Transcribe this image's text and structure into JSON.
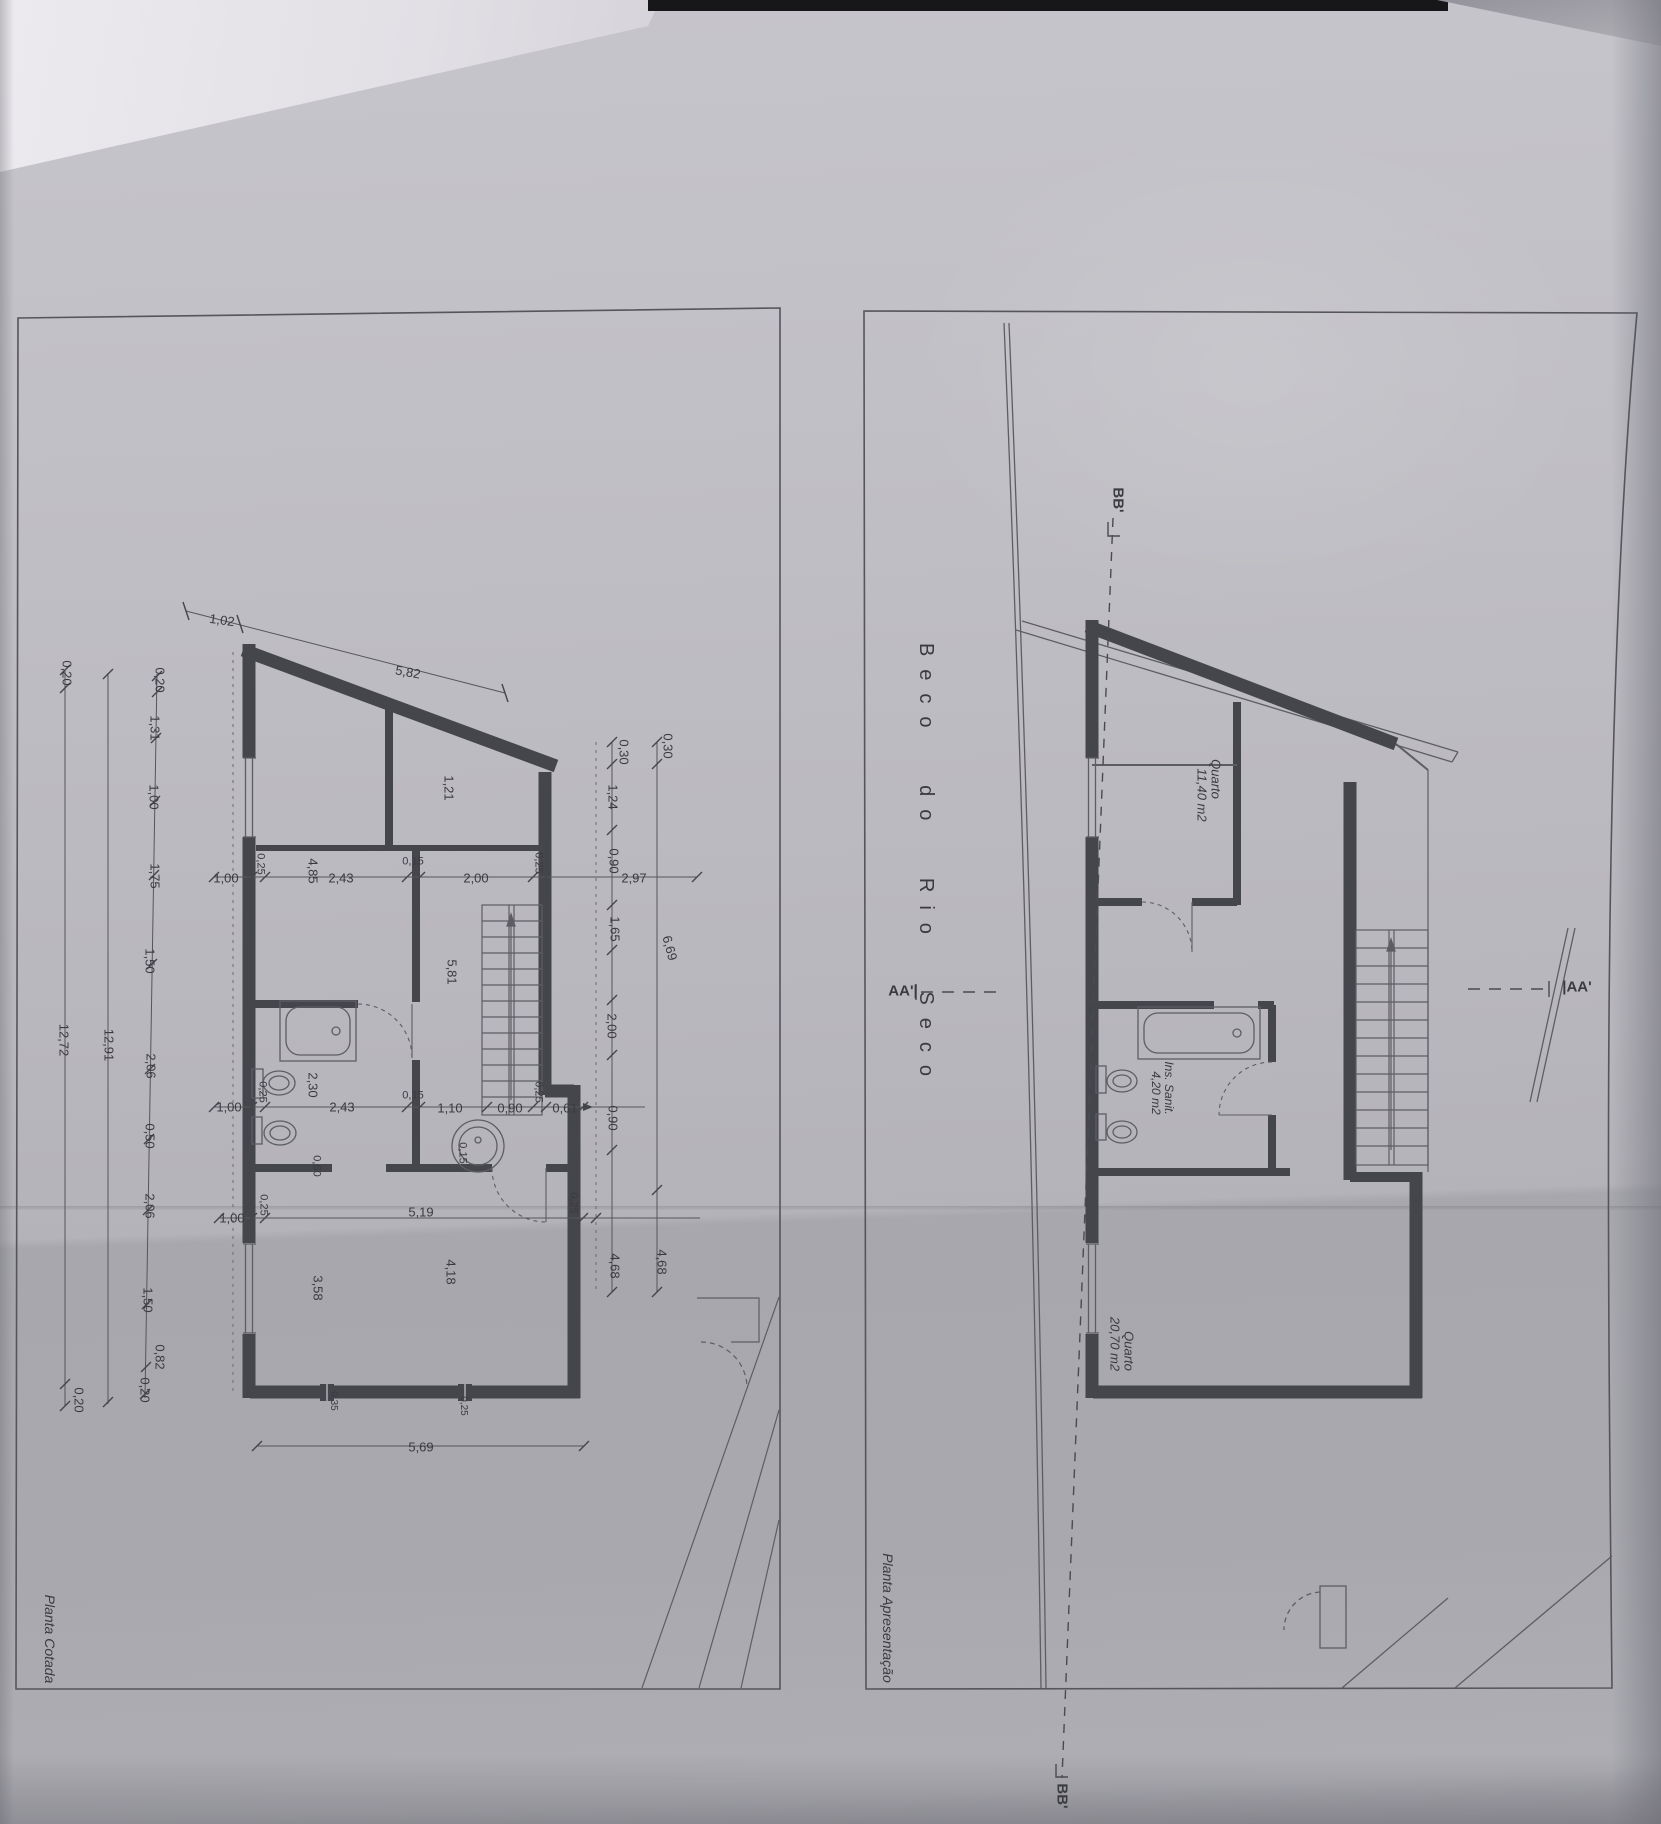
{
  "sheet": {
    "street_name": "Beco do Rio Seco",
    "section_markers": [
      "AA'",
      "BB'"
    ],
    "panels": [
      {
        "id": "planta-cotada",
        "title": "Planta Cotada"
      },
      {
        "id": "planta-apresentacao",
        "title": "Planta Apresentação"
      }
    ],
    "rooms": [
      {
        "name": "Quarto",
        "area": "11,40 m2"
      },
      {
        "name": "Ins. Sanit.",
        "area": "4,20 m2"
      },
      {
        "name": "Quarto",
        "area": "20,70 m2"
      }
    ]
  },
  "colors": {
    "paper": "#b8b7bd",
    "wall": "#45454c",
    "line": "#5d5d64",
    "text": "#3a3a41"
  },
  "annotations": [
    {
      "t": "1,02",
      "x": 222,
      "y": 620,
      "r": 8,
      "n": "dim-1-02"
    },
    {
      "t": "5,82",
      "x": 408,
      "y": 672,
      "r": 10,
      "n": "dim-5-82"
    },
    {
      "t": "0,20",
      "x": 67,
      "y": 673,
      "r": 90
    },
    {
      "t": "12,72",
      "x": 64,
      "y": 1040,
      "r": 90
    },
    {
      "t": "0,20",
      "x": 79,
      "y": 1400,
      "r": 90
    },
    {
      "t": "12,91",
      "x": 109,
      "y": 1045,
      "r": 90
    },
    {
      "t": "0,20",
      "x": 160,
      "y": 680,
      "r": 90
    },
    {
      "t": "1,31",
      "x": 155,
      "y": 728,
      "r": 90
    },
    {
      "t": "1,00",
      "x": 154,
      "y": 797,
      "r": 90
    },
    {
      "t": "1,75",
      "x": 155,
      "y": 876,
      "r": 90
    },
    {
      "t": "1,50",
      "x": 150,
      "y": 961,
      "r": 90
    },
    {
      "t": "2,06",
      "x": 151,
      "y": 1066,
      "r": 90
    },
    {
      "t": "0,50",
      "x": 150,
      "y": 1136,
      "r": 90
    },
    {
      "t": "2,06",
      "x": 150,
      "y": 1206,
      "r": 90
    },
    {
      "t": "1,50",
      "x": 148,
      "y": 1300,
      "r": 90
    },
    {
      "t": "0,82",
      "x": 160,
      "y": 1357,
      "r": 90
    },
    {
      "t": "0,20",
      "x": 145,
      "y": 1390,
      "r": 90
    },
    {
      "t": "1,00",
      "x": 226,
      "y": 878
    },
    {
      "t": "0,25",
      "x": 260,
      "y": 864,
      "r": 90,
      "s": 11
    },
    {
      "t": "4,85",
      "x": 313,
      "y": 871,
      "r": 90
    },
    {
      "t": "2,43",
      "x": 341,
      "y": 878
    },
    {
      "t": "0,15",
      "x": 413,
      "y": 862,
      "s": 11
    },
    {
      "t": "2,00",
      "x": 476,
      "y": 878
    },
    {
      "t": "0,25",
      "x": 538,
      "y": 863,
      "r": 90,
      "s": 11
    },
    {
      "t": "2,97",
      "x": 634,
      "y": 878
    },
    {
      "t": "0,90",
      "x": 614,
      "y": 861,
      "r": 90
    },
    {
      "t": "1,65",
      "x": 615,
      "y": 929,
      "r": 90
    },
    {
      "t": "6,69",
      "x": 670,
      "y": 948,
      "r": 75
    },
    {
      "t": "0,30",
      "x": 624,
      "y": 752,
      "r": 90
    },
    {
      "t": "0,30",
      "x": 668,
      "y": 746,
      "r": 90
    },
    {
      "t": "1,24",
      "x": 613,
      "y": 797,
      "r": 90
    },
    {
      "t": "1,21",
      "x": 449,
      "y": 788,
      "r": 90
    },
    {
      "t": "5,81",
      "x": 452,
      "y": 972,
      "r": 90
    },
    {
      "t": "1,00",
      "x": 229,
      "y": 1107
    },
    {
      "t": "0,25",
      "x": 262,
      "y": 1092,
      "r": 90,
      "s": 11
    },
    {
      "t": "2,30",
      "x": 313,
      "y": 1085,
      "r": 90
    },
    {
      "t": "2,43",
      "x": 342,
      "y": 1107
    },
    {
      "t": "0,15",
      "x": 413,
      "y": 1096,
      "s": 11
    },
    {
      "t": "1,10",
      "x": 450,
      "y": 1108
    },
    {
      "t": "0,90",
      "x": 510,
      "y": 1108
    },
    {
      "t": "0,25",
      "x": 538,
      "y": 1092,
      "r": 90,
      "s": 11
    },
    {
      "t": "0,61",
      "x": 565,
      "y": 1108
    },
    {
      "t": "0,90",
      "x": 613,
      "y": 1118,
      "r": 90
    },
    {
      "t": "2,00",
      "x": 612,
      "y": 1026,
      "r": 90
    },
    {
      "t": "0,15",
      "x": 462,
      "y": 1153,
      "r": 90,
      "s": 11
    },
    {
      "t": "0,60",
      "x": 316,
      "y": 1166,
      "r": 90,
      "s": 11
    },
    {
      "t": "1,00",
      "x": 232,
      "y": 1218
    },
    {
      "t": "0,25",
      "x": 263,
      "y": 1205,
      "r": 90,
      "s": 11
    },
    {
      "t": "5,19",
      "x": 421,
      "y": 1212
    },
    {
      "t": "0,25",
      "x": 573,
      "y": 1203,
      "r": 90,
      "s": 11
    },
    {
      "t": "3,58",
      "x": 318,
      "y": 1288,
      "r": 90
    },
    {
      "t": "4,18",
      "x": 451,
      "y": 1272,
      "r": 90
    },
    {
      "t": "4,68",
      "x": 615,
      "y": 1266,
      "r": 90
    },
    {
      "t": "4,68",
      "x": 662,
      "y": 1262,
      "r": 90
    },
    {
      "t": "0,35",
      "x": 333,
      "y": 1401,
      "r": 90,
      "s": 10
    },
    {
      "t": "0,25",
      "x": 463,
      "y": 1406,
      "r": 90,
      "s": 10
    },
    {
      "t": "5,69",
      "x": 421,
      "y": 1447
    },
    {
      "t": "Planta Cotada",
      "x": 50,
      "y": 1639,
      "r": 90,
      "s": 14,
      "i": 1,
      "n": "left-panel-title"
    },
    {
      "t": "Planta Apresentação",
      "x": 888,
      "y": 1618,
      "r": 90,
      "s": 14,
      "i": 1,
      "n": "right-panel-title"
    },
    {
      "t": "Beco do Rio Seco",
      "x": 926,
      "y": 866,
      "r": 90,
      "s": 20,
      "ls": 13,
      "ws": 26,
      "n": "street-name"
    },
    {
      "t": "BB'",
      "x": 1118,
      "y": 500,
      "r": 90,
      "s": 15,
      "b": 1,
      "n": "section-marker-bb-top"
    },
    {
      "t": "BB'",
      "x": 1062,
      "y": 1796,
      "r": 90,
      "s": 15,
      "b": 1,
      "n": "section-marker-bb-bottom"
    },
    {
      "t": "AA'|",
      "x": 903,
      "y": 991,
      "s": 15,
      "b": 1,
      "n": "section-marker-aa-left"
    },
    {
      "t": "|AA'",
      "x": 1577,
      "y": 987,
      "s": 15,
      "b": 1,
      "n": "section-marker-aa-right"
    },
    {
      "t": "Quarto",
      "x": 1216,
      "y": 779,
      "r": 90,
      "s": 13,
      "i": 1,
      "n": "room-label-quarto-1"
    },
    {
      "t": "11,40 m2",
      "x": 1202,
      "y": 795,
      "r": 90,
      "s": 13,
      "i": 1,
      "n": "room-area-quarto-1"
    },
    {
      "t": "Ins. Sanit.",
      "x": 1169,
      "y": 1088,
      "r": 90,
      "s": 12,
      "i": 1,
      "n": "room-label-ins-sanit"
    },
    {
      "t": "4,20 m2",
      "x": 1156,
      "y": 1093,
      "r": 90,
      "s": 12,
      "i": 1,
      "n": "room-area-ins-sanit"
    },
    {
      "t": "Quarto",
      "x": 1129,
      "y": 1351,
      "r": 90,
      "s": 13,
      "i": 1,
      "n": "room-label-quarto-2"
    },
    {
      "t": "20,70 m2",
      "x": 1115,
      "y": 1344,
      "r": 90,
      "s": 13,
      "i": 1,
      "n": "room-area-quarto-2"
    }
  ]
}
